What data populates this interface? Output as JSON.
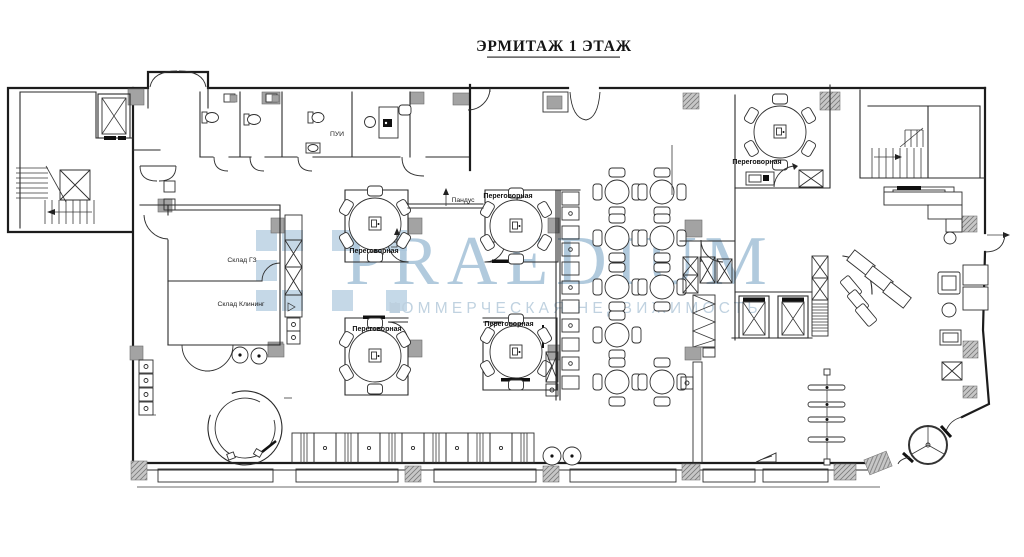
{
  "title": "ЭРМИТАЖ 1 ЭТАЖ",
  "watermark": {
    "brand": "PRAEDIUM",
    "tagline": "КОММЕРЧЕСКАЯ НЕДВИЖИМОСТЬ",
    "brand_color": "#a9c5da",
    "tagline_color": "#bdd0df",
    "logo_color": "#b7cfe2"
  },
  "rooms": {
    "meeting_top_left": "Переговорная",
    "meeting_top_right": "Переговорная",
    "meeting_bottom_left": "Переговорная",
    "meeting_bottom_right": "Переговорная",
    "meeting_east": "Переговорная",
    "storage_gz": "Склад ГЗ",
    "storage_cleaning": "Склад Клининг",
    "cleaning_room": "ПУИ",
    "ramp": "Пандус"
  }
}
